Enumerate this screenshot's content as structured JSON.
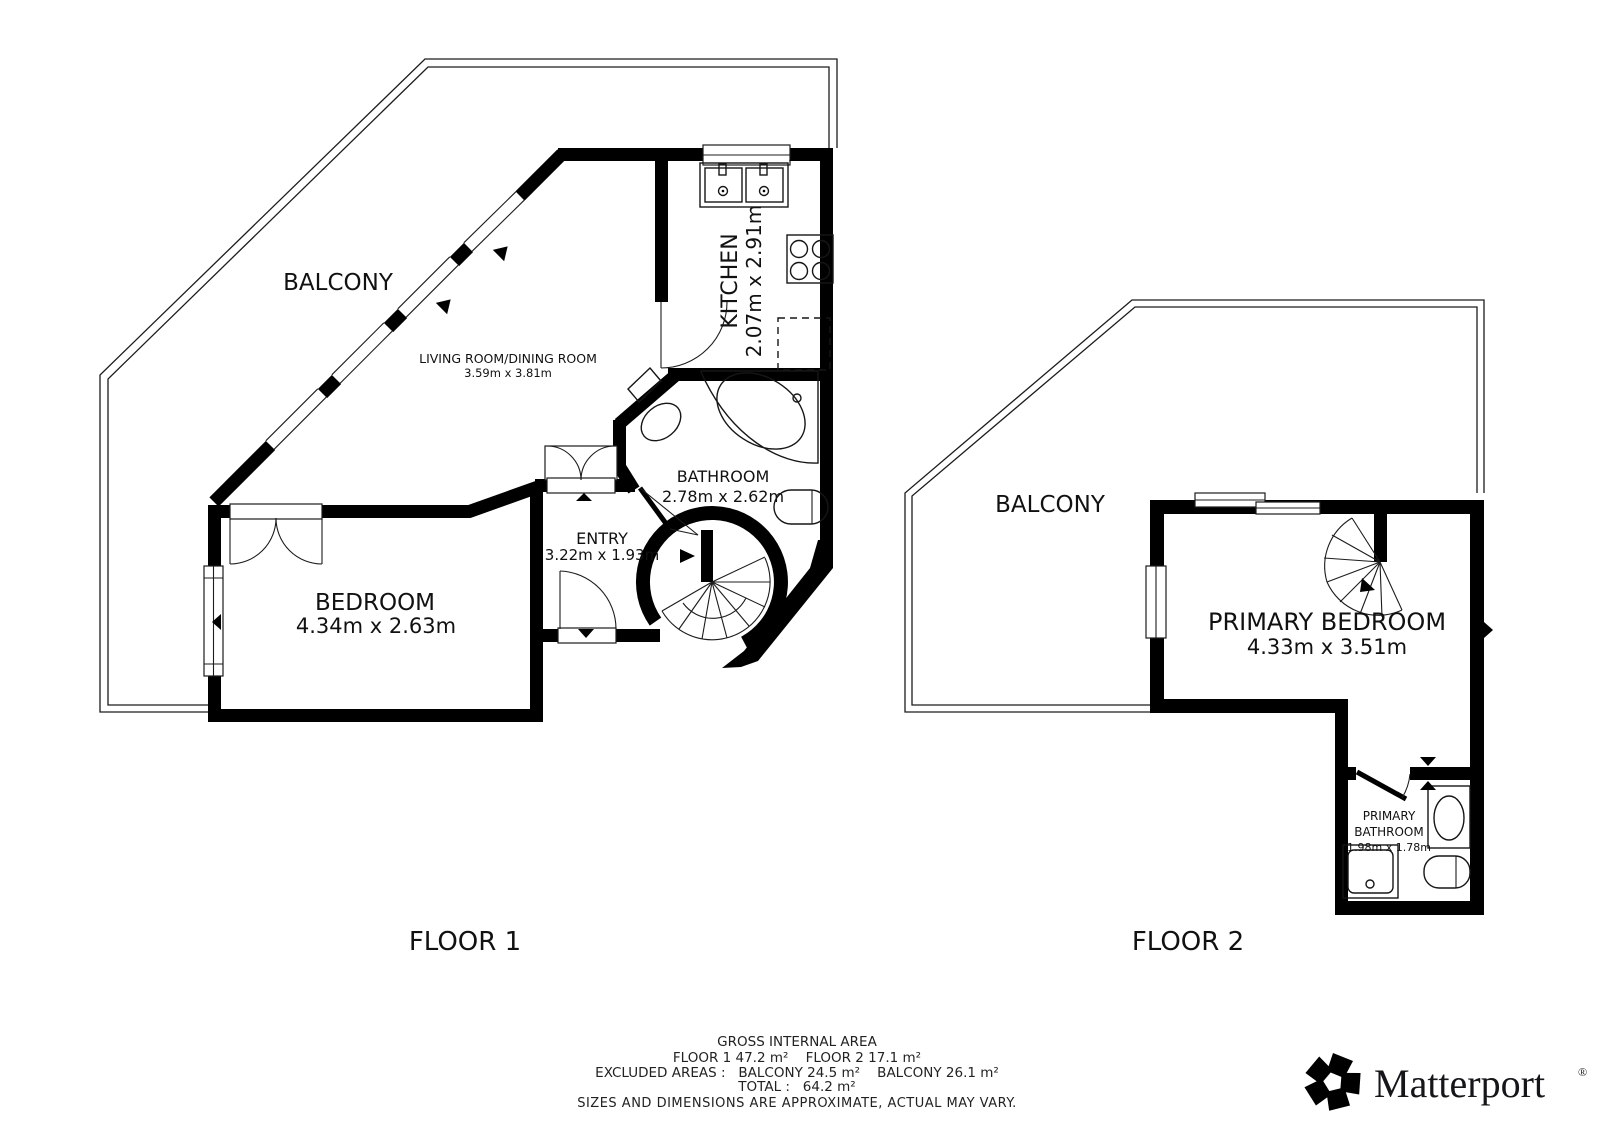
{
  "floor1": {
    "title": "FLOOR 1",
    "balcony_label": "BALCONY",
    "living_room": {
      "name": "LIVING ROOM/DINING ROOM",
      "dims": "3.59m x 3.81m"
    },
    "kitchen": {
      "name": "KITCHEN",
      "dims": "2.07m x 2.91m"
    },
    "bathroom": {
      "name": "BATHROOM",
      "dims": "2.78m x 2.62m"
    },
    "entry": {
      "name": "ENTRY",
      "dims": "3.22m x 1.93m"
    },
    "bedroom": {
      "name": "BEDROOM",
      "dims": "4.34m x 2.63m"
    }
  },
  "floor2": {
    "title": "FLOOR 2",
    "balcony_label": "BALCONY",
    "primary_bedroom": {
      "name": "PRIMARY BEDROOM",
      "dims": "4.33m x 3.51m"
    },
    "primary_bathroom": {
      "line1": "PRIMARY",
      "line2": "BATHROOM",
      "dims": "1.98m x 1.78m"
    }
  },
  "footer": {
    "title": "GROSS INTERNAL AREA",
    "areas_line": "FLOOR 1 47.2 m²    FLOOR 2 17.1 m²",
    "excluded_line": "EXCLUDED AREAS :   BALCONY 24.5 m²    BALCONY 26.1 m²",
    "total_line": "TOTAL :   64.2 m²",
    "disclaimer": "SIZES AND DIMENSIONS ARE APPROXIMATE, ACTUAL MAY VARY."
  },
  "brand": {
    "name": "Matterport",
    "registered_mark": "®"
  },
  "colors": {
    "walls": "#000000",
    "background": "#ffffff",
    "disclaimer_text": "#9b9b9b",
    "label_text": "#111111"
  }
}
